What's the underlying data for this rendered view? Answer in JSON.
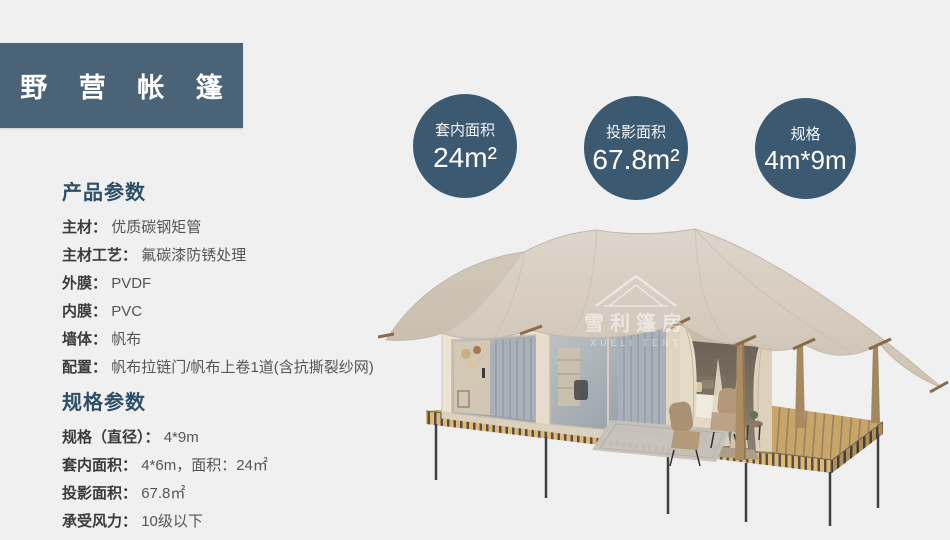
{
  "theme": {
    "background": "#f0f0f1",
    "title_box_color": "#4a6377",
    "circle_color": "#3b5970",
    "heading_color": "#2e4f68",
    "label_color": "#3b3b3b",
    "value_color": "#555555",
    "text_on_dark": "#ffffff"
  },
  "title": {
    "text": "野 营 帐 篷"
  },
  "stat_circles": [
    {
      "label": "套内面积",
      "value": "24m²"
    },
    {
      "label": "投影面积",
      "value": "67.8m²"
    },
    {
      "label": "规格",
      "value": "4m*9m"
    }
  ],
  "product_params": {
    "heading": "产品参数",
    "items": [
      {
        "label": "主材：",
        "value": "优质碳钢矩管"
      },
      {
        "label": "主材工艺：",
        "value": "氟碳漆防锈处理"
      },
      {
        "label": "外膜：",
        "value": "PVDF"
      },
      {
        "label": "内膜：",
        "value": "PVC"
      },
      {
        "label": "墙体：",
        "value": "帆布"
      },
      {
        "label": "配置：",
        "value": "帆布拉链门/帆布上卷1道(含抗撕裂纱网)"
      }
    ]
  },
  "spec_params": {
    "heading": "规格参数",
    "items": [
      {
        "label": "规格（直径）：",
        "value": "4*9m"
      },
      {
        "label": "套内面积：",
        "value": "4*6m，面积：24㎡"
      },
      {
        "label": "投影面积：",
        "value": "67.8㎡"
      },
      {
        "label": "承受风力：",
        "value": "10级以下"
      }
    ]
  },
  "tent_image": {
    "watermark_cn": "雪利篷房",
    "watermark_en": "XUELI TENT"
  }
}
